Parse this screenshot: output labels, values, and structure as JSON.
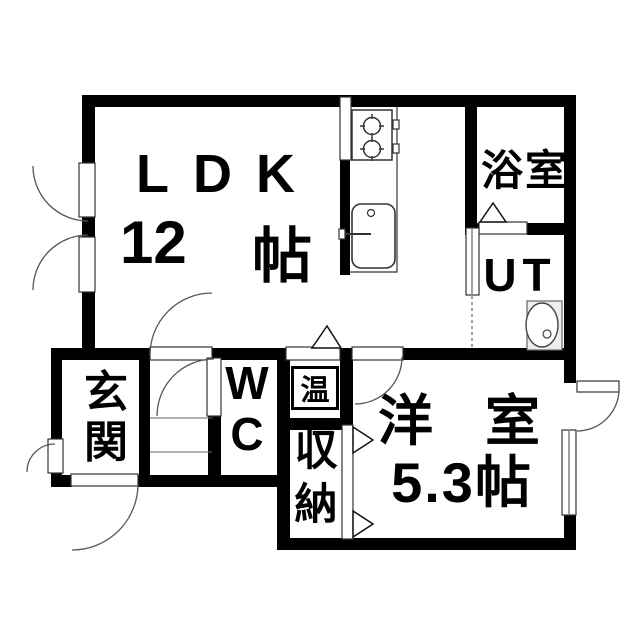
{
  "page": {
    "background": "#ffffff",
    "type": "floor-plan"
  },
  "colors": {
    "wall": "#000000",
    "fixture_line": "#3a3a3a",
    "arc_line": "#555555"
  },
  "rooms": {
    "ldk": {
      "label": "LDK",
      "area_value": "12",
      "area_unit": "帖"
    },
    "bathroom": {
      "label": "浴室"
    },
    "utility": {
      "label": "UT"
    },
    "entrance": {
      "label": "玄関",
      "chars": [
        "玄",
        "関"
      ]
    },
    "wc": {
      "label": "WC",
      "chars": [
        "W",
        "C"
      ]
    },
    "water_heater": {
      "label": "温"
    },
    "storage": {
      "label": "収納",
      "chars": [
        "収",
        "納"
      ]
    },
    "western_room": {
      "label": "洋室",
      "chars": [
        "洋",
        "室"
      ],
      "area": "5.3帖"
    }
  },
  "fixtures": [
    "gas-stove",
    "kitchen-sink",
    "washbasin",
    "casement-window",
    "door-swing",
    "folding-door"
  ]
}
